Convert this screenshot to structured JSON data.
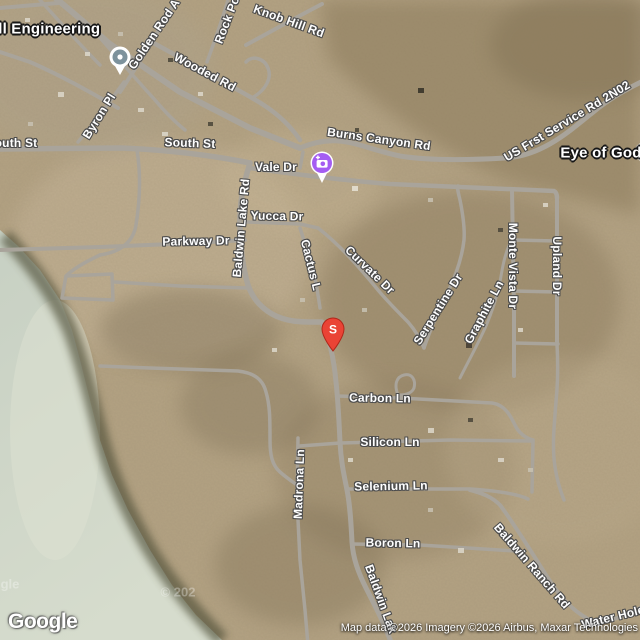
{
  "map": {
    "view": "satellite",
    "logo": "Google",
    "attribution": "Map data ©2026 Imagery ©2026 Airbus, Maxar Technologies",
    "colors": {
      "terrain_base": "#b3a283",
      "water": "#ccd4c5",
      "road": "#a9a49b",
      "location_pin_red": "#ea4335",
      "photo_pin_purple": "#a45df2",
      "place_pin_slate": "#7d929c"
    },
    "markers": {
      "location_pin": {
        "letter": "S",
        "x": 320,
        "y": 316
      },
      "photo_pin": {
        "icon": "camera-plus",
        "x": 308,
        "y": 150
      },
      "place_pin": {
        "icon": "poi-dot",
        "x": 107,
        "y": 44
      },
      "edge_poi": {
        "icon": "poi-circle-partial",
        "x": 643,
        "y": 152
      }
    },
    "labels": [
      {
        "text": "rill Engineering",
        "x": 44,
        "y": 29,
        "rot": 0,
        "kind": "poi"
      },
      {
        "text": "Eye of God",
        "x": 601,
        "y": 153,
        "rot": 0,
        "kind": "poi"
      },
      {
        "text": "Golden Rod A",
        "x": 154,
        "y": 34,
        "rot": -56,
        "kind": "road"
      },
      {
        "text": "Rock Po",
        "x": 227,
        "y": 20,
        "rot": -69,
        "kind": "road"
      },
      {
        "text": "Knob Hill Rd",
        "x": 289,
        "y": 21,
        "rot": 20,
        "kind": "road"
      },
      {
        "text": "Wooded Rd",
        "x": 205,
        "y": 72,
        "rot": 28,
        "kind": "road"
      },
      {
        "text": "Byron Pl",
        "x": 99,
        "y": 116,
        "rot": -58,
        "kind": "road"
      },
      {
        "text": "outh St",
        "x": 16,
        "y": 143,
        "rot": 0,
        "kind": "road"
      },
      {
        "text": "South St",
        "x": 190,
        "y": 143,
        "rot": 2,
        "kind": "road"
      },
      {
        "text": "Vale Dr",
        "x": 276,
        "y": 167,
        "rot": 0,
        "kind": "road"
      },
      {
        "text": "Burns Canyon Rd",
        "x": 379,
        "y": 139,
        "rot": 8,
        "kind": "road"
      },
      {
        "text": "US Frst Service Rd 2N02",
        "x": 567,
        "y": 121,
        "rot": -31,
        "kind": "road"
      },
      {
        "text": "Yucca Dr",
        "x": 277,
        "y": 216,
        "rot": 1,
        "kind": "road"
      },
      {
        "text": "Baldwin Lake Rd",
        "x": 241,
        "y": 228,
        "rot": -85,
        "kind": "road"
      },
      {
        "text": "Parkway Dr",
        "x": 196,
        "y": 241,
        "rot": -1,
        "kind": "road"
      },
      {
        "text": "Cactus L",
        "x": 311,
        "y": 265,
        "rot": 76,
        "kind": "road"
      },
      {
        "text": "Curvate Dr",
        "x": 370,
        "y": 270,
        "rot": 44,
        "kind": "road"
      },
      {
        "text": "Serpentine Dr",
        "x": 438,
        "y": 309,
        "rot": -58,
        "kind": "road"
      },
      {
        "text": "Graphite Ln",
        "x": 484,
        "y": 312,
        "rot": -62,
        "kind": "road"
      },
      {
        "text": "Monte Vista Dr",
        "x": 513,
        "y": 266,
        "rot": 90,
        "kind": "road"
      },
      {
        "text": "Upland Dr",
        "x": 557,
        "y": 266,
        "rot": 90,
        "kind": "road"
      },
      {
        "text": "Carbon Ln",
        "x": 380,
        "y": 398,
        "rot": 1,
        "kind": "road"
      },
      {
        "text": "Silicon Ln",
        "x": 390,
        "y": 442,
        "rot": 0,
        "kind": "road"
      },
      {
        "text": "Madrona Ln",
        "x": 299,
        "y": 484,
        "rot": -88,
        "kind": "road"
      },
      {
        "text": "Selenium Ln",
        "x": 391,
        "y": 486,
        "rot": -1,
        "kind": "road"
      },
      {
        "text": "Boron Ln",
        "x": 393,
        "y": 543,
        "rot": 1,
        "kind": "road"
      },
      {
        "text": "Baldwin Ranch Rd",
        "x": 532,
        "y": 566,
        "rot": 49,
        "kind": "road"
      },
      {
        "text": "Water Hole",
        "x": 613,
        "y": 617,
        "rot": -14,
        "kind": "road"
      },
      {
        "text": "Baldwin Lak",
        "x": 381,
        "y": 599,
        "rot": 70,
        "kind": "road"
      },
      {
        "text": "gle",
        "x": 10,
        "y": 584,
        "rot": 0,
        "kind": "wm"
      },
      {
        "text": "© 202",
        "x": 178,
        "y": 592,
        "rot": 0,
        "kind": "wm"
      }
    ]
  }
}
